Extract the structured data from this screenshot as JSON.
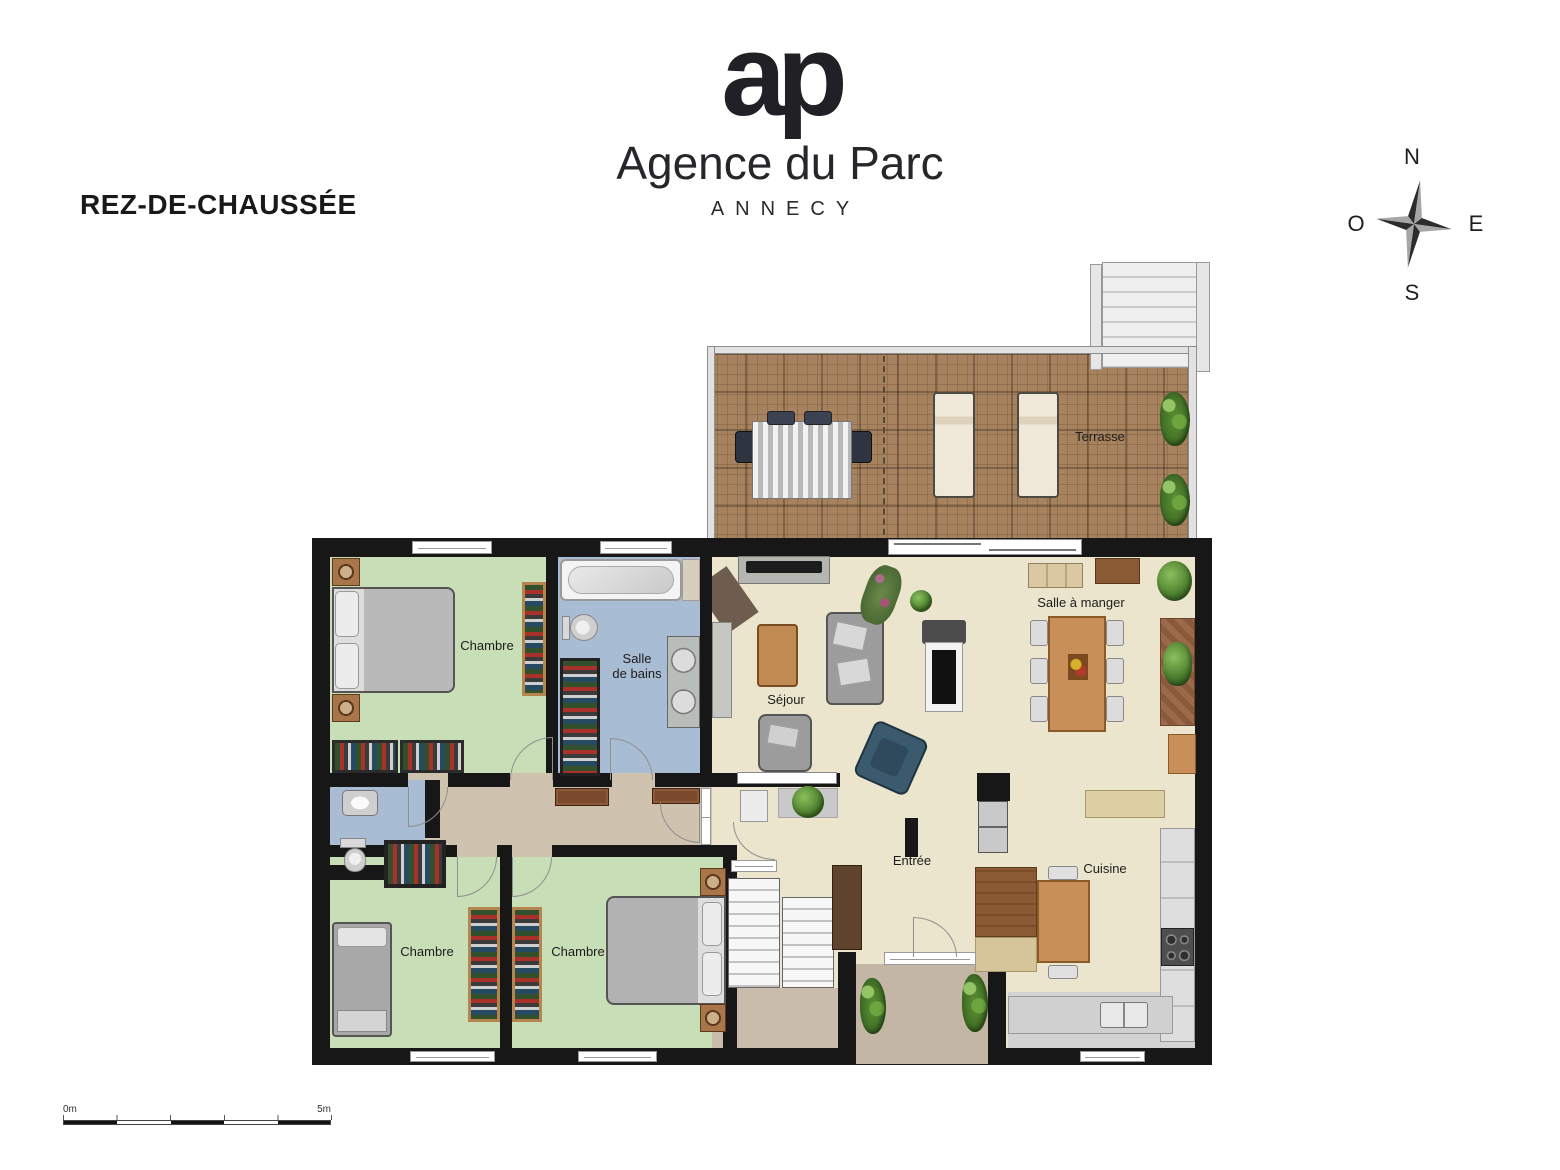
{
  "header": {
    "title": "REZ-DE-CHAUSSÉE"
  },
  "brand": {
    "monogram": "ap",
    "name": "Agence du Parc",
    "city": "ANNECY"
  },
  "compass": {
    "n": "N",
    "e": "E",
    "s": "S",
    "o": "O"
  },
  "rooms": {
    "terrasse": "Terrasse",
    "chambre_nord": "Chambre",
    "salle_de_bains_l1": "Salle",
    "salle_de_bains_l2": "de bains",
    "sejour": "Séjour",
    "salle_a_manger": "Salle à manger",
    "chambre_ouest": "Chambre",
    "chambre_sud": "Chambre",
    "entree": "Entrée",
    "cuisine": "Cuisine"
  },
  "scale_bar": {
    "start": "0m",
    "end": "5m"
  },
  "colors": {
    "wall": "#171717",
    "bedroom_floor": "#c7deb6",
    "bathroom_floor": "#a8bdd4",
    "living_floor": "#ebe5cd",
    "hallway_floor": "#cfc2ae",
    "terrace_floor": "#a6825f",
    "porch_floor": "#c4b6a4"
  }
}
